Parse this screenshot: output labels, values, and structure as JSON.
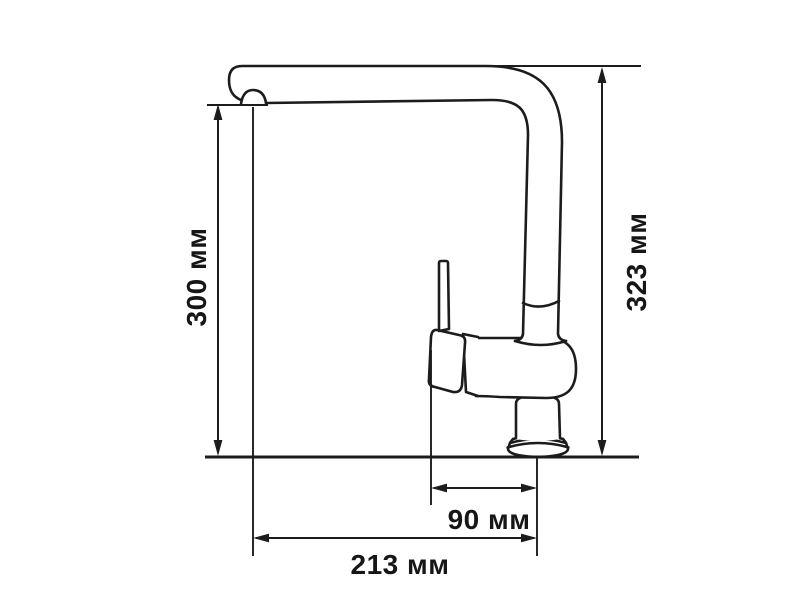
{
  "page": {
    "background_color": "#ffffff",
    "line_color": "#1c1c1c"
  },
  "drawing": {
    "subject": "Kitchen faucet side-view dimensional drawing",
    "unit": "мм",
    "dimensions": {
      "spout_height": {
        "label": "300 мм",
        "value": 300,
        "unit": "мм",
        "orientation": "vertical",
        "side": "left"
      },
      "total_height": {
        "label": "323 мм",
        "value": 323,
        "unit": "мм",
        "orientation": "vertical",
        "side": "right"
      },
      "base_offset": {
        "label": "90 мм",
        "value": 90,
        "unit": "мм",
        "orientation": "horizontal",
        "side": "bottom-inner"
      },
      "spout_reach": {
        "label": "213 мм",
        "value": 213,
        "unit": "мм",
        "orientation": "horizontal",
        "side": "bottom-outer"
      }
    }
  }
}
